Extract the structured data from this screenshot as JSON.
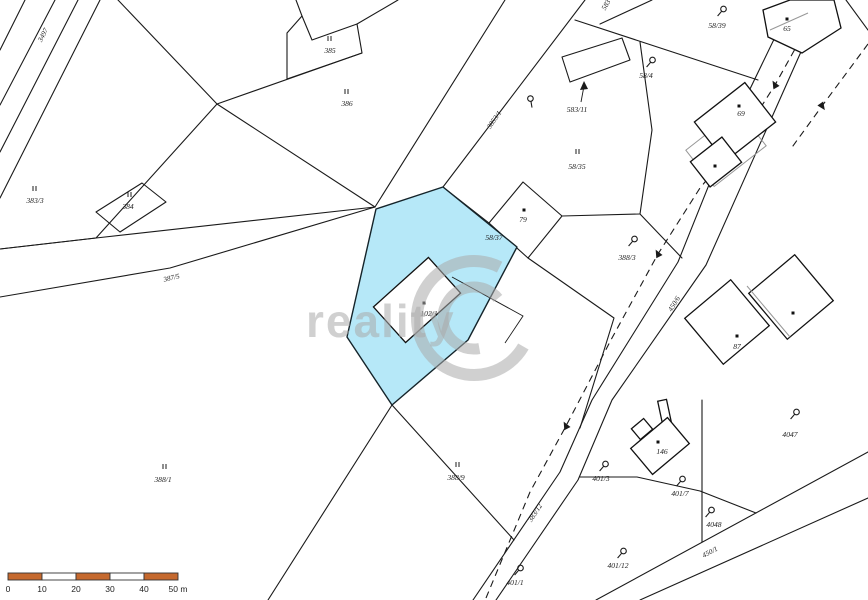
{
  "map": {
    "background": "#ffffff",
    "line_color": "#1a1a1a",
    "highlight_color": "#b6e8f8",
    "labels": [
      {
        "text": "3497",
        "x": 45,
        "y": 36,
        "rot": -62,
        "cls": "road"
      },
      {
        "text": "II",
        "x": 35,
        "y": 191,
        "cls": "roman"
      },
      {
        "text": "383/3",
        "x": 35,
        "y": 203,
        "cls": "num"
      },
      {
        "text": "II",
        "x": 130,
        "y": 197,
        "cls": "roman"
      },
      {
        "text": "384",
        "x": 128,
        "y": 209,
        "cls": "num"
      },
      {
        "text": "II",
        "x": 330,
        "y": 41,
        "cls": "roman"
      },
      {
        "text": "385",
        "x": 330,
        "y": 53,
        "cls": "num"
      },
      {
        "text": "II",
        "x": 347,
        "y": 94,
        "cls": "roman"
      },
      {
        "text": "386",
        "x": 347,
        "y": 106,
        "cls": "num"
      },
      {
        "text": "387/5",
        "x": 172,
        "y": 280,
        "rot": -13,
        "cls": "road"
      },
      {
        "text": "3853/1",
        "x": 496,
        "y": 121,
        "rot": -56,
        "cls": "road"
      },
      {
        "text": "583",
        "x": 608,
        "y": 6,
        "rot": -60,
        "cls": "road"
      },
      {
        "text": "583/11",
        "x": 577,
        "y": 112,
        "cls": "num"
      },
      {
        "text": "II",
        "x": 578,
        "y": 154,
        "cls": "roman"
      },
      {
        "text": "58/35",
        "x": 577,
        "y": 169,
        "cls": "num"
      },
      {
        "text": "79",
        "x": 523,
        "y": 222,
        "cls": "num"
      },
      {
        "text": "58/37",
        "x": 494,
        "y": 240,
        "cls": "num"
      },
      {
        "text": "388/3",
        "x": 627,
        "y": 260,
        "cls": "num"
      },
      {
        "text": "102/1",
        "x": 429,
        "y": 316,
        "cls": "num"
      },
      {
        "text": "58/39",
        "x": 717,
        "y": 28,
        "cls": "num"
      },
      {
        "text": "58/4",
        "x": 646,
        "y": 78,
        "cls": "num"
      },
      {
        "text": "65",
        "x": 787,
        "y": 31,
        "cls": "num"
      },
      {
        "text": "69",
        "x": 741,
        "y": 116,
        "cls": "num"
      },
      {
        "text": "450/6",
        "x": 676,
        "y": 305,
        "rot": -58,
        "cls": "road"
      },
      {
        "text": "87",
        "x": 737,
        "y": 349,
        "cls": "num"
      },
      {
        "text": "4047",
        "x": 790,
        "y": 437,
        "cls": "num"
      },
      {
        "text": "146",
        "x": 662,
        "y": 454,
        "cls": "num"
      },
      {
        "text": "401/3",
        "x": 601,
        "y": 481,
        "cls": "num"
      },
      {
        "text": "401/7",
        "x": 680,
        "y": 496,
        "cls": "num"
      },
      {
        "text": "4048",
        "x": 714,
        "y": 527,
        "cls": "num"
      },
      {
        "text": "450/1",
        "x": 711,
        "y": 554,
        "rot": -28,
        "cls": "road"
      },
      {
        "text": "383/12",
        "x": 537,
        "y": 514,
        "rot": -57,
        "cls": "road"
      },
      {
        "text": "401/12",
        "x": 618,
        "y": 568,
        "cls": "num"
      },
      {
        "text": "401/1",
        "x": 515,
        "y": 585,
        "cls": "num"
      },
      {
        "text": "II",
        "x": 165,
        "y": 469,
        "cls": "roman"
      },
      {
        "text": "388/1",
        "x": 163,
        "y": 482,
        "cls": "num"
      },
      {
        "text": "II",
        "x": 458,
        "y": 467,
        "cls": "roman"
      },
      {
        "text": "388/9",
        "x": 456,
        "y": 480,
        "cls": "num"
      }
    ],
    "flags": [
      {
        "x": 531,
        "y": 101,
        "rot": -50
      },
      {
        "x": 633,
        "y": 241,
        "rot": 0
      },
      {
        "x": 722,
        "y": 11,
        "rot": 0
      },
      {
        "x": 651,
        "y": 62,
        "rot": 0
      },
      {
        "x": 795,
        "y": 414,
        "rot": 0
      },
      {
        "x": 604,
        "y": 466,
        "rot": 0
      },
      {
        "x": 681,
        "y": 481,
        "rot": 0
      },
      {
        "x": 710,
        "y": 512,
        "rot": 0
      },
      {
        "x": 622,
        "y": 553,
        "rot": 0
      },
      {
        "x": 519,
        "y": 570,
        "rot": 0
      }
    ],
    "dots": [
      {
        "x": 524,
        "y": 210
      },
      {
        "x": 787,
        "y": 19
      },
      {
        "x": 739,
        "y": 106
      },
      {
        "x": 715,
        "y": 166
      },
      {
        "x": 737,
        "y": 336
      },
      {
        "x": 793,
        "y": 313
      },
      {
        "x": 658,
        "y": 442
      },
      {
        "x": 424,
        "y": 303
      }
    ]
  },
  "watermark": {
    "text": "reality",
    "color": "rgba(170,170,170,0.55)"
  },
  "scale_bar": {
    "unit_labels": [
      "0",
      "10",
      "20",
      "30",
      "40",
      "50 m"
    ],
    "segments": 5,
    "bar_color": "#c5692e",
    "alt_color": "#ffffff"
  }
}
